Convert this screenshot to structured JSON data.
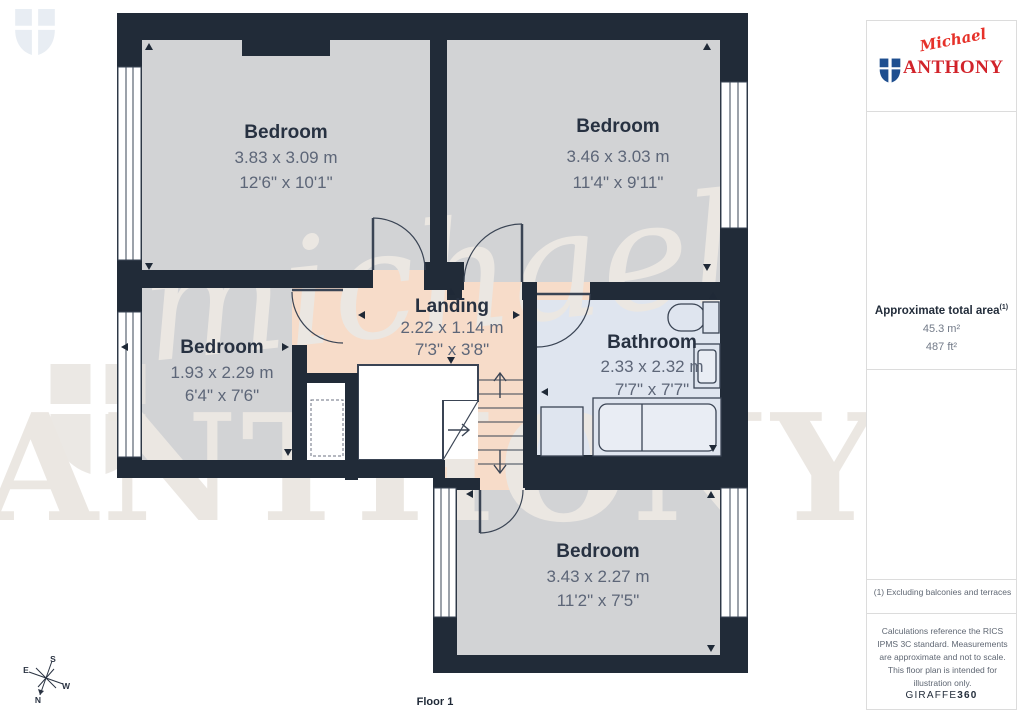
{
  "floor_label": "Floor 1",
  "rooms": {
    "bedroom_top_left": {
      "name": "Bedroom",
      "metric": "3.83 x 3.09 m",
      "imperial": "12'6\" x 10'1\""
    },
    "bedroom_top_right": {
      "name": "Bedroom",
      "metric": "3.46 x 3.03 m",
      "imperial": "11'4\" x 9'11\""
    },
    "bedroom_left": {
      "name": "Bedroom",
      "metric": "1.93 x 2.29 m",
      "imperial": "6'4\" x 7'6\""
    },
    "landing": {
      "name": "Landing",
      "metric": "2.22 x 1.14 m",
      "imperial": "7'3\" x 3'8\""
    },
    "bathroom": {
      "name": "Bathroom",
      "metric": "2.33 x 2.32 m",
      "imperial": "7'7\" x 7'7\""
    },
    "bedroom_bottom": {
      "name": "Bedroom",
      "metric": "3.43 x 2.27 m",
      "imperial": "11'2\" x 7'5\""
    }
  },
  "sidebar": {
    "brand": {
      "script": "Michael",
      "name": "ANTHONY"
    },
    "area_title": "Approximate total area",
    "area_sup": "(1)",
    "area_m2": "45.3 m²",
    "area_ft2": "487 ft²",
    "footnote": "(1) Excluding balconies and terraces",
    "disclaimer": "Calculations reference the RICS IPMS 3C standard. Measurements are approximate and not to scale. This floor plan is intended for illustration only.",
    "giraffe_regular": "GIRAFFE",
    "giraffe_bold": "360"
  },
  "watermark": {
    "script": "michael",
    "name": "ANTHONY"
  },
  "compass": {
    "n": "N",
    "e": "E",
    "s": "S",
    "w": "W"
  },
  "colors": {
    "wall": "#212b38",
    "room_fill": "#d2d3d5",
    "landing_fill": "#f7dcc9",
    "bathroom_fill": "#dfe5ef",
    "brand_red": "#d2232a",
    "brand_blue": "#1e4e8f",
    "label_dark": "#273141",
    "dim_gray": "#5d6678"
  }
}
